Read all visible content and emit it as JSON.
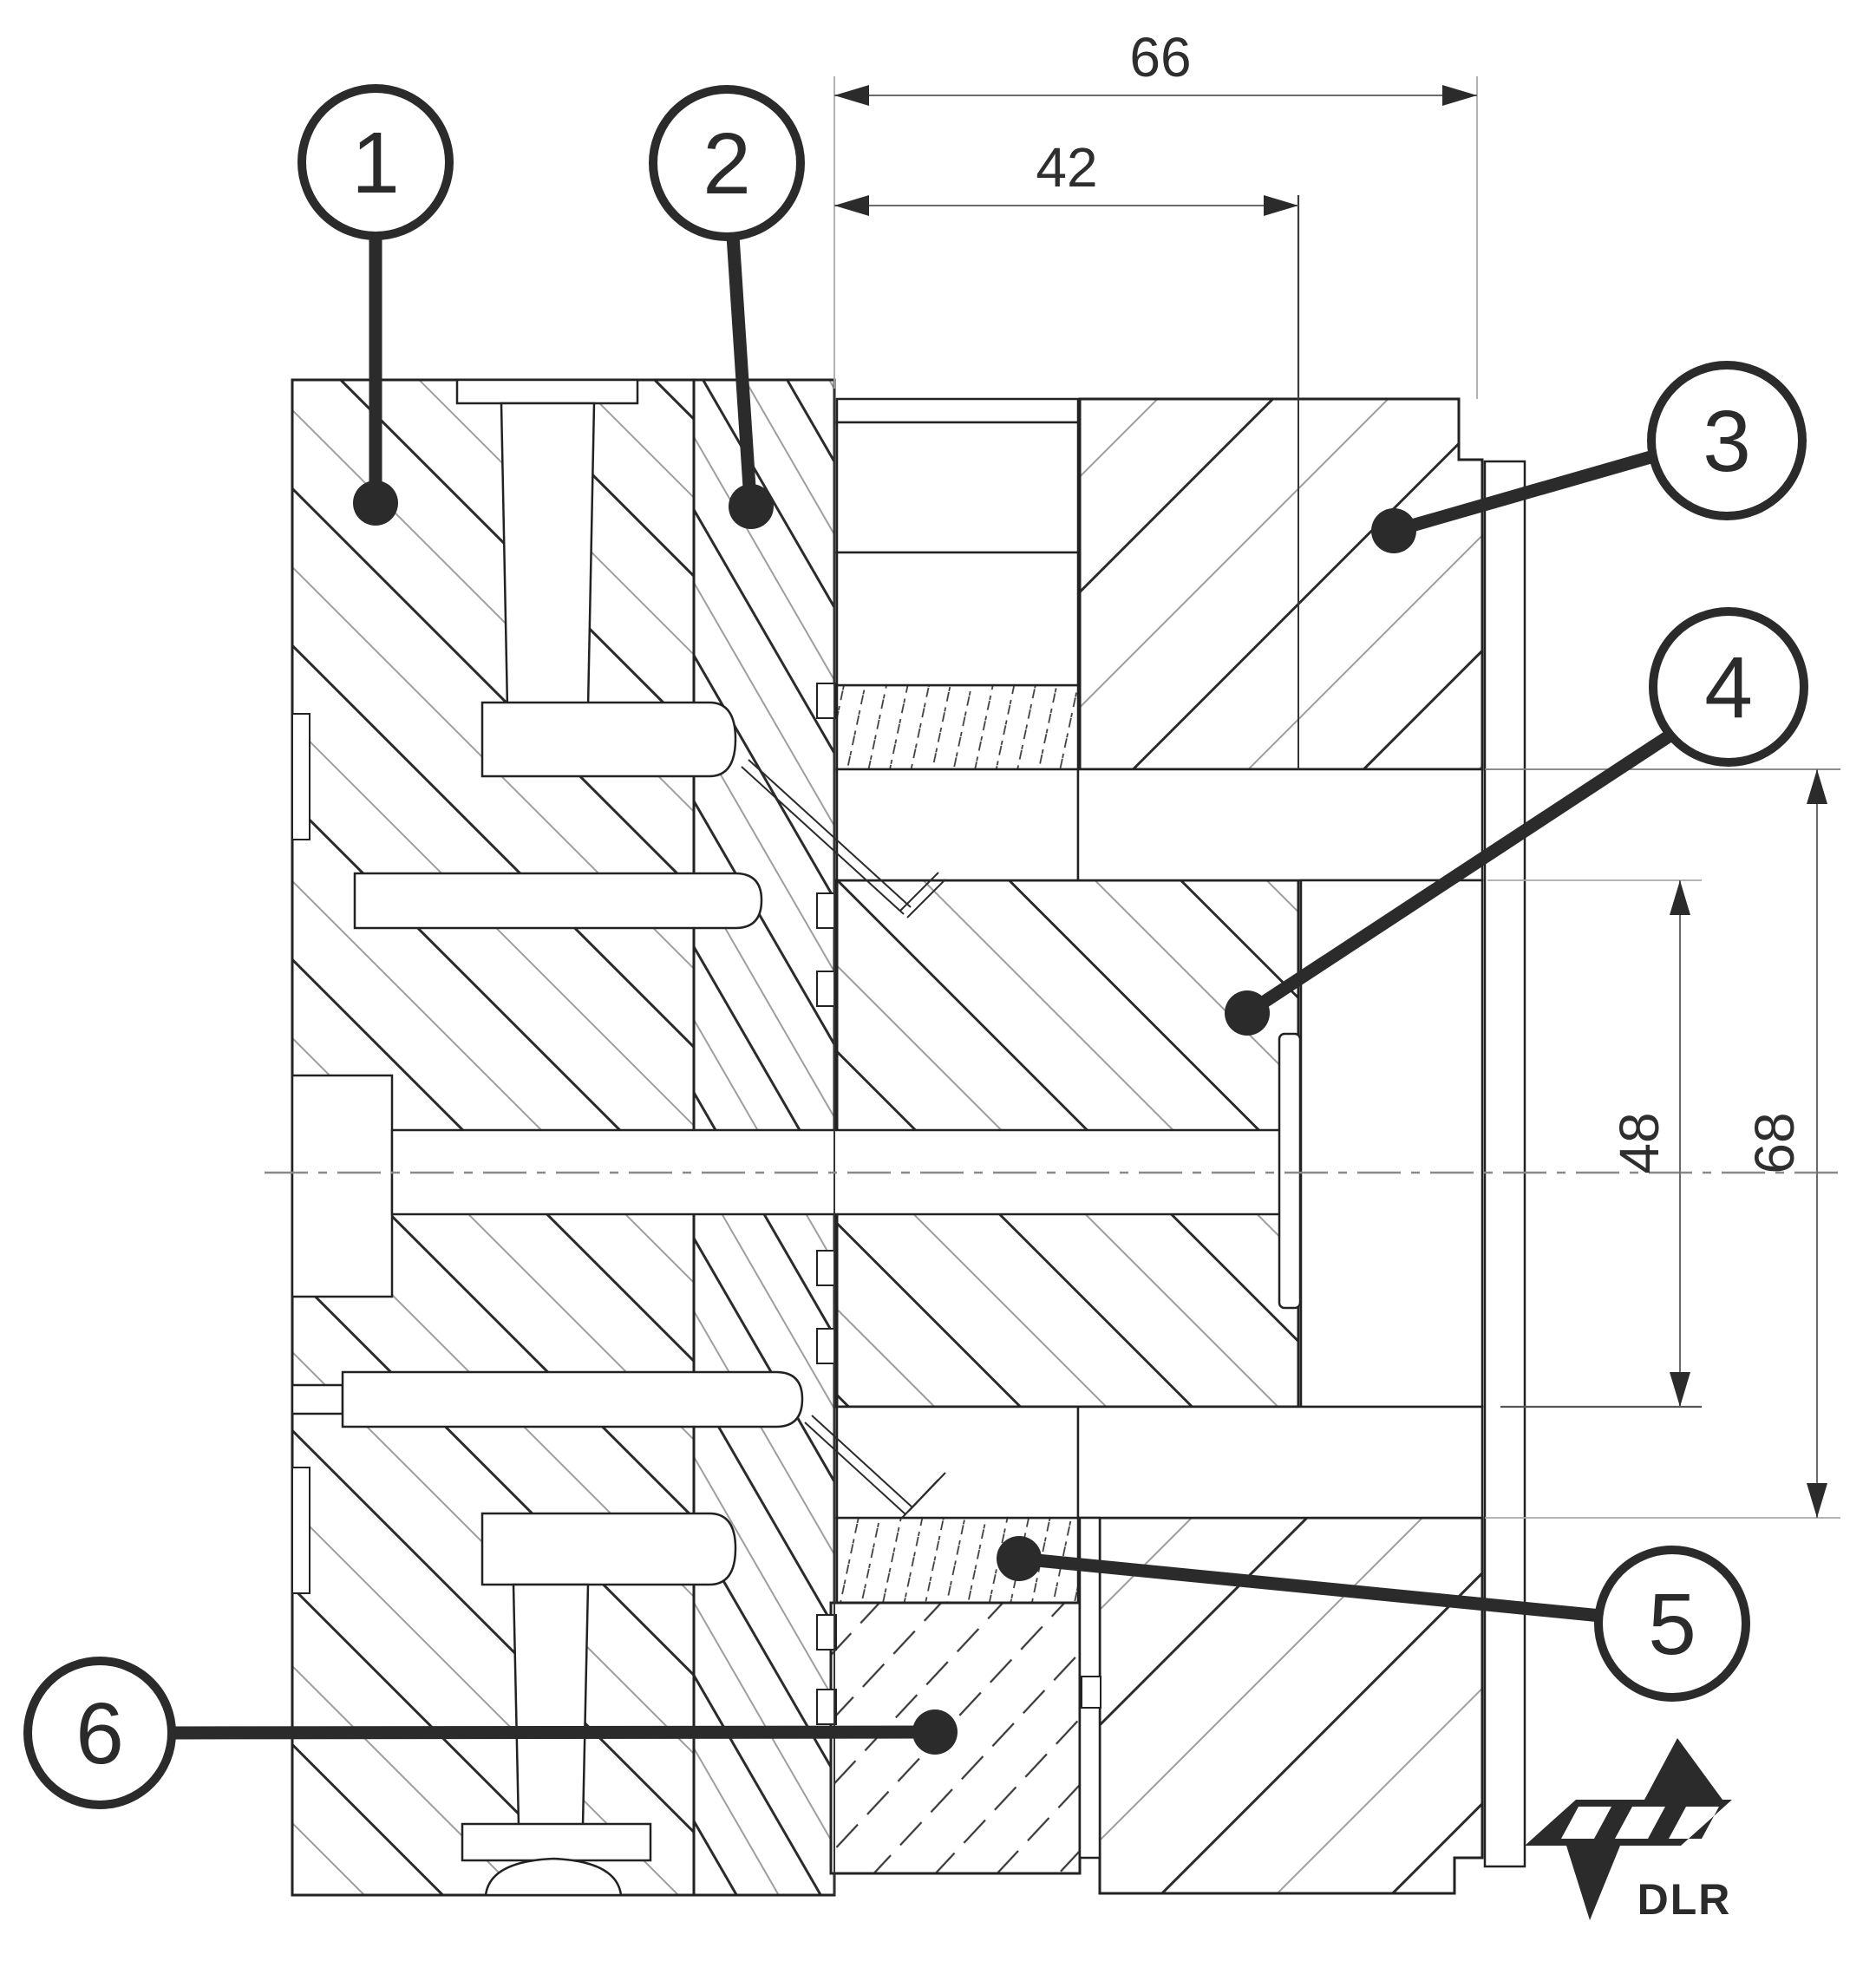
{
  "drawing": {
    "balloons": [
      {
        "label": "1"
      },
      {
        "label": "2"
      },
      {
        "label": "3"
      },
      {
        "label": "4"
      },
      {
        "label": "5"
      },
      {
        "label": "6"
      }
    ],
    "dimensions": {
      "top_outer": "66",
      "top_inner": "42",
      "right_inner": "48",
      "right_outer": "68"
    },
    "logo": {
      "text": "DLR"
    },
    "colors": {
      "line": "#2b2b2b",
      "hatch_gray": "#9e9e9e",
      "dim_line": "#6b6b6b",
      "background": "#ffffff"
    }
  }
}
